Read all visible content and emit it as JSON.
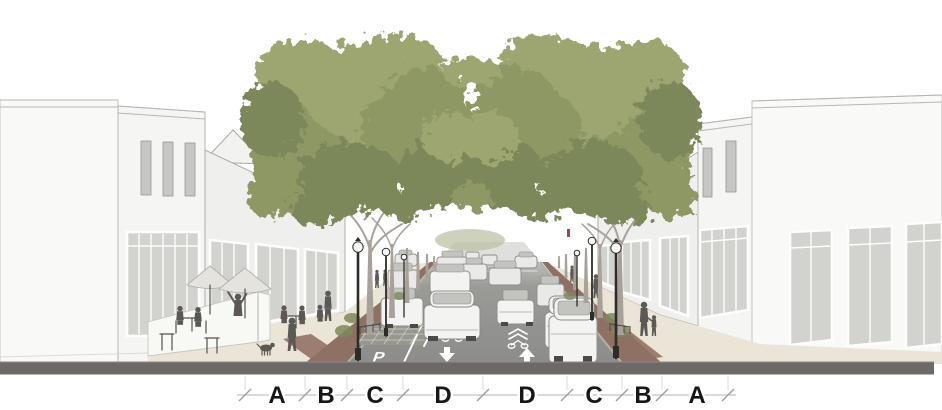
{
  "dimensions": {
    "labels": [
      "A",
      "B",
      "C",
      "D",
      "D",
      "C",
      "B",
      "A"
    ]
  },
  "road": {
    "parking_left": "P",
    "parking_right": "P"
  },
  "icons": {
    "lane_arrow_down": "arrow-down",
    "lane_arrow_up": "arrow-up",
    "sharrow_left": "bike-sharrow",
    "sharrow_right": "bike-sharrow"
  },
  "colors": {
    "tree_foliage": "#8e9865",
    "road_asphalt": "#8c8c8c",
    "section_band": "#6c6966",
    "sidewalk_paving": "#eae5d7",
    "brick_accent": "#8f7164",
    "building_facade": "#f3f3f1",
    "storefront_glass": "#cfcfcc",
    "figure_silhouette": "#5b5855",
    "lane_marking": "#ffffff",
    "dimension_text": "#171717"
  }
}
